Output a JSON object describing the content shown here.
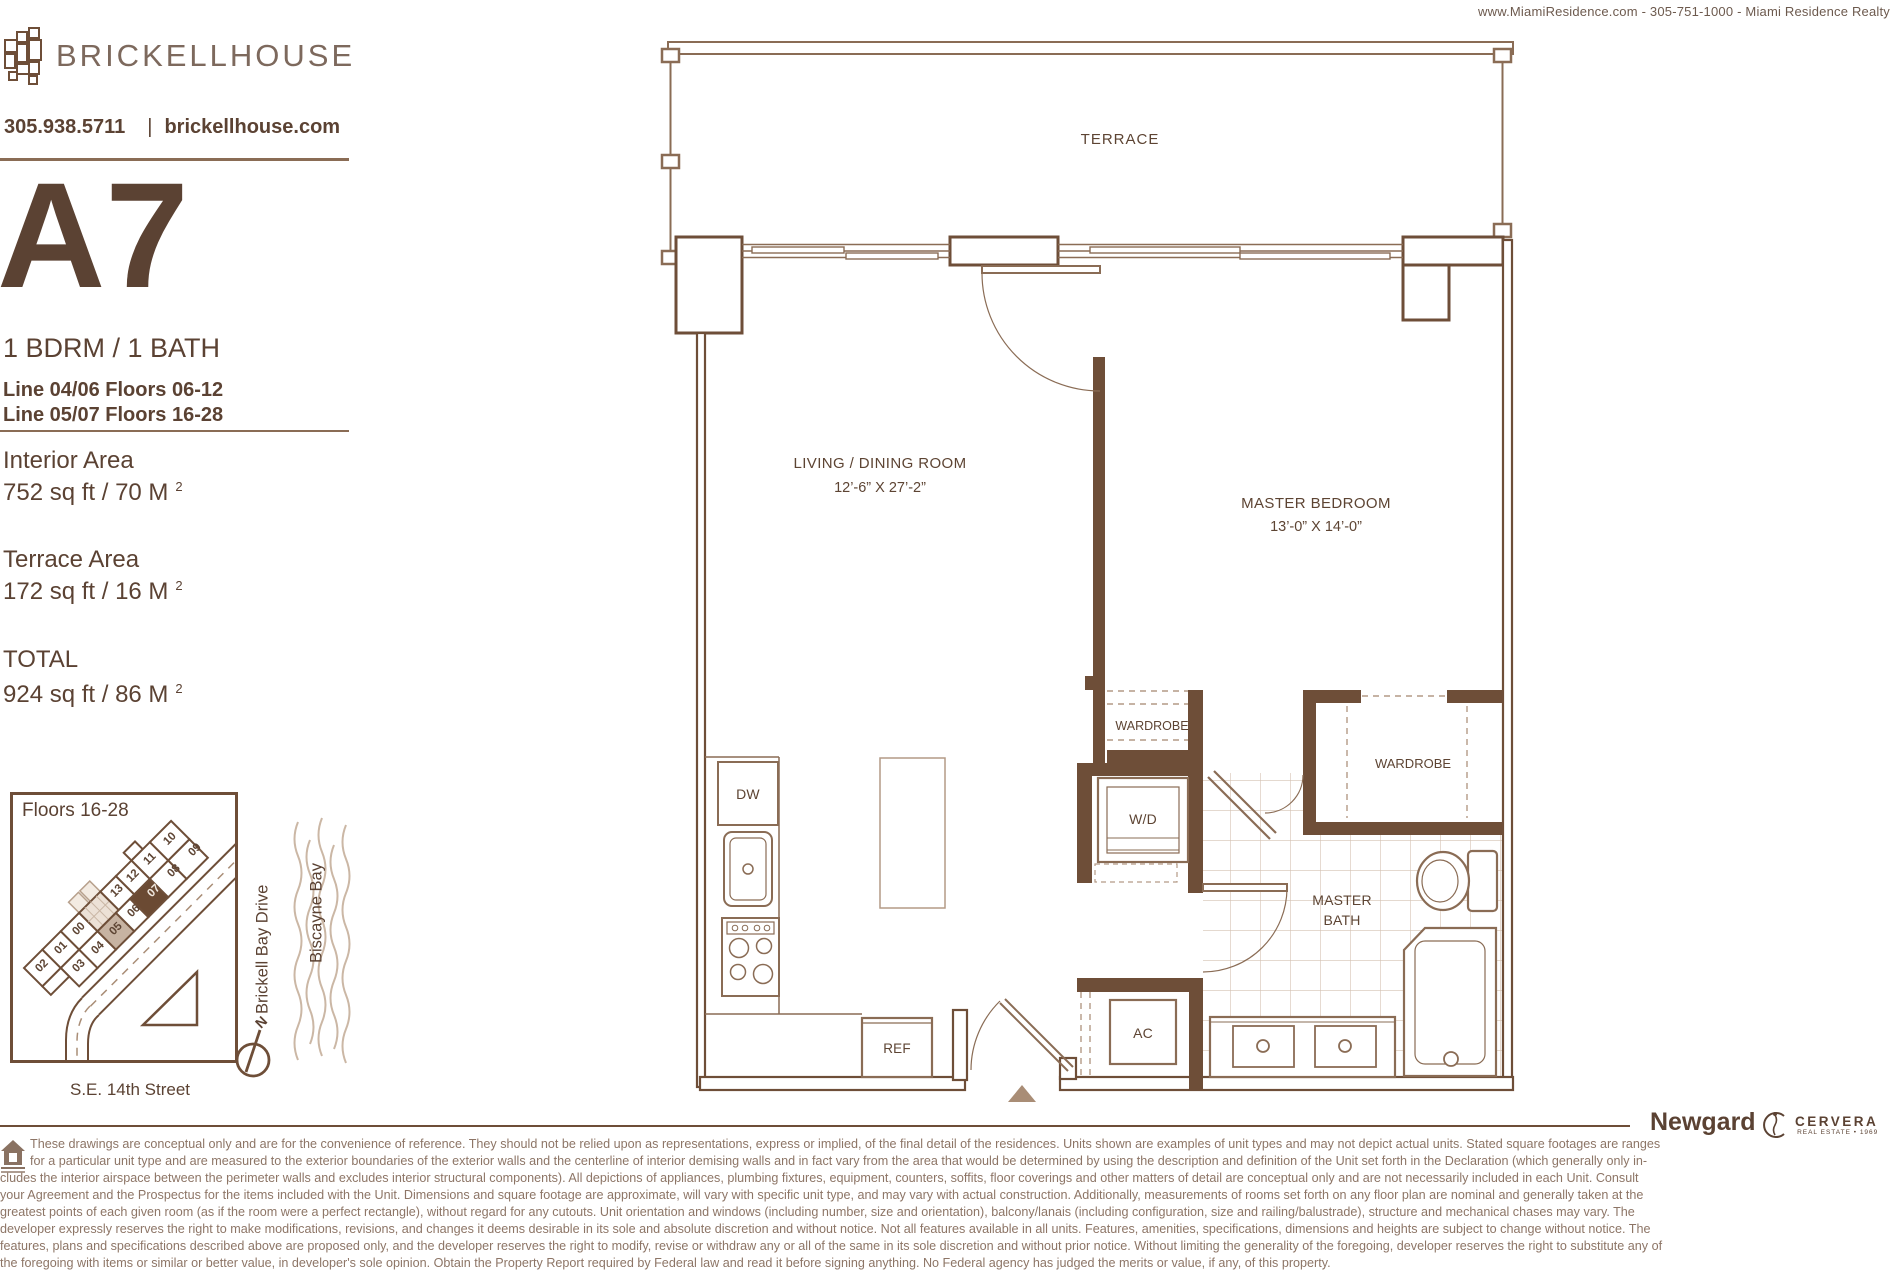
{
  "header": {
    "realtor_line": "www.MiamiResidence.com  -  305-751-1000  -  Miami Residence Realty"
  },
  "sidebar": {
    "brand": "BRICKELLHOUSE",
    "phone": "305.938.5711",
    "divider": "|",
    "website": "brickellhouse.com",
    "unit": "A7",
    "config": "1 BDRM  / 1 BATH",
    "lines": [
      "Line 04/06  Floors 06-12",
      "Line 05/07  Floors 16-28"
    ],
    "interior": {
      "label": "Interior Area",
      "value": "752 sq ft / 70 M",
      "sup": "2"
    },
    "terrace": {
      "label": "Terrace Area",
      "value": "172 sq ft / 16 M",
      "sup": "2"
    },
    "total": {
      "label": "TOTAL",
      "value": "924 sq ft / 86 M",
      "sup": "2"
    }
  },
  "keyplan": {
    "title": "Floors 16-28",
    "units": [
      "02",
      "01",
      "00",
      "13",
      "12",
      "11",
      "10",
      "03",
      "04",
      "05",
      "06",
      "07",
      "08",
      "09"
    ],
    "highlight_dark": "#6b4a33",
    "highlight_tan": "#c7b3a2",
    "streets": {
      "brickell_bay_drive": "Brickell Bay Drive",
      "biscayne_bay": "Biscayne Bay",
      "se_14th": "S.E. 14th Street"
    },
    "north": "N"
  },
  "plan": {
    "terrace": "TERRACE",
    "living": {
      "name": "LIVING  / DINING ROOM",
      "dims": "12’-6” X 27’-2”"
    },
    "bedroom": {
      "name": "MASTER BEDROOM",
      "dims": "13’-0” X 14’-0”"
    },
    "wardrobe1": "WARDROBE",
    "wardrobe2": "WARDROBE",
    "wd": "W/D",
    "bath": {
      "line1": "MASTER",
      "line2": "BATH"
    },
    "ac": "AC",
    "dw": "DW",
    "ref": "REF"
  },
  "footer": {
    "newgard": "Newgard",
    "cervera": "CERVERA",
    "cervera_sub": "REAL ESTATE • 1969"
  },
  "disclaimer": {
    "lines": [
      "These drawings are conceptual only and are for the convenience of reference. They should not be relied upon as representations, express or implied, of the final detail of the residences.  Units shown are examples of unit types and may not depict actual units.  Stated square footages are ranges",
      "for a particular unit type and are measured to the exterior boundaries of the exterior walls and the centerline of interior demising walls and in fact vary from the area that would be determined by using the description and definition of the Unit set forth in the Declaration (which generally only in-",
      "cludes the interior airspace between the perimeter walls and excludes interior structural components).  All depictions of appliances, plumbing fixtures, equipment, counters, soffits, floor coverings and other matters of detail are conceptual only and are not necessarily included in each Unit.  Consult",
      "your Agreement and the Prospectus for the items included with the Unit.  Dimensions and square footage are approximate, will vary with specific unit type, and may vary with actual construction.  Additionally, measurements of rooms set forth on any floor plan are nominal and generally taken at the",
      "greatest points of each given room (as if the room were a perfect rectangle), without regard for any cutouts.  Unit orientation and windows (including number, size and orientation), balcony/lanais (including configuration, size and railing/balustrade), structure and mechanical chases may vary.  The",
      "developer expressly reserves the right to make modifications, revisions, and changes it deems desirable in its sole and absolute discretion and without notice.  Not all features available in all units. Features, amenities, specifications, dimensions and heights are subject to change without notice. The",
      "features, plans and specifications described above are proposed only, and the developer reserves the right to modify, revise or withdraw any or all of the same in its sole discretion and without prior notice. Without limiting the generality of the foregoing, developer reserves the right to substitute any of",
      "the foregoing with items or similar or better value, in developer's sole opinion. Obtain the Property Report required by Federal law and read it before signing anything. No Federal agency has judged the merits or value, if any, of this property."
    ]
  }
}
